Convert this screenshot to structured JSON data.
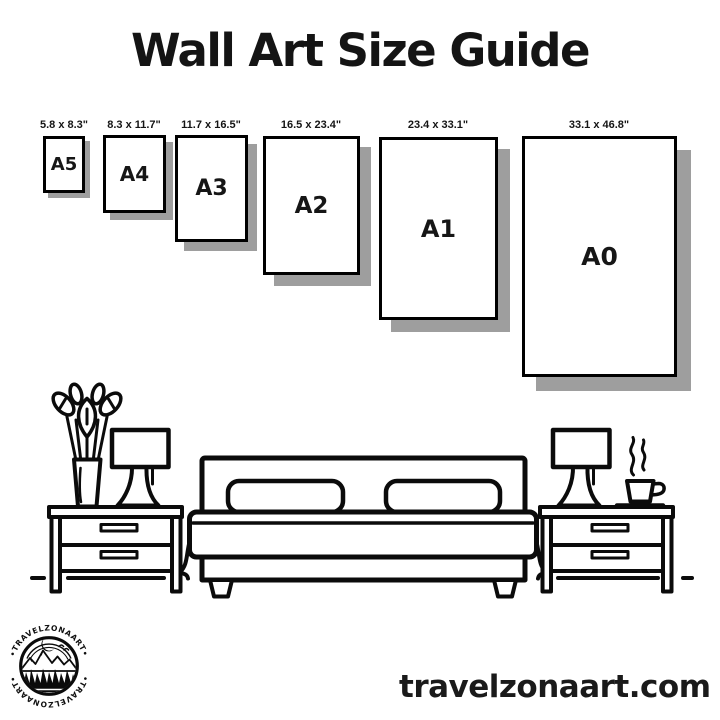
{
  "page": {
    "title": "Wall Art Size Guide",
    "website": "travelzonaart.com",
    "background_color": "#ffffff",
    "ink_color": "#0b0b0b",
    "shadow_color": "#9e9e9e"
  },
  "size_guide": {
    "unit": "inches",
    "sizes": [
      {
        "name": "A5",
        "dimensions": "5.8 x 8.3\""
      },
      {
        "name": "A4",
        "dimensions": "8.3 x 11.7\""
      },
      {
        "name": "A3",
        "dimensions": "11.7 x 16.5\""
      },
      {
        "name": "A2",
        "dimensions": "16.5 x 23.4\""
      },
      {
        "name": "A1",
        "dimensions": "23.4 x 33.1\""
      },
      {
        "name": "A0",
        "dimensions": "33.1 x 46.8\""
      }
    ]
  },
  "logo": {
    "badge_text_top": "•TRAVELZONAART•",
    "badge_text_bottom": "•TRAVELZONAART•"
  },
  "illustration": {
    "alt": "line-art bedroom: bed with two pillows, two nightstands with lamps, plant vase, steaming coffee cup"
  }
}
